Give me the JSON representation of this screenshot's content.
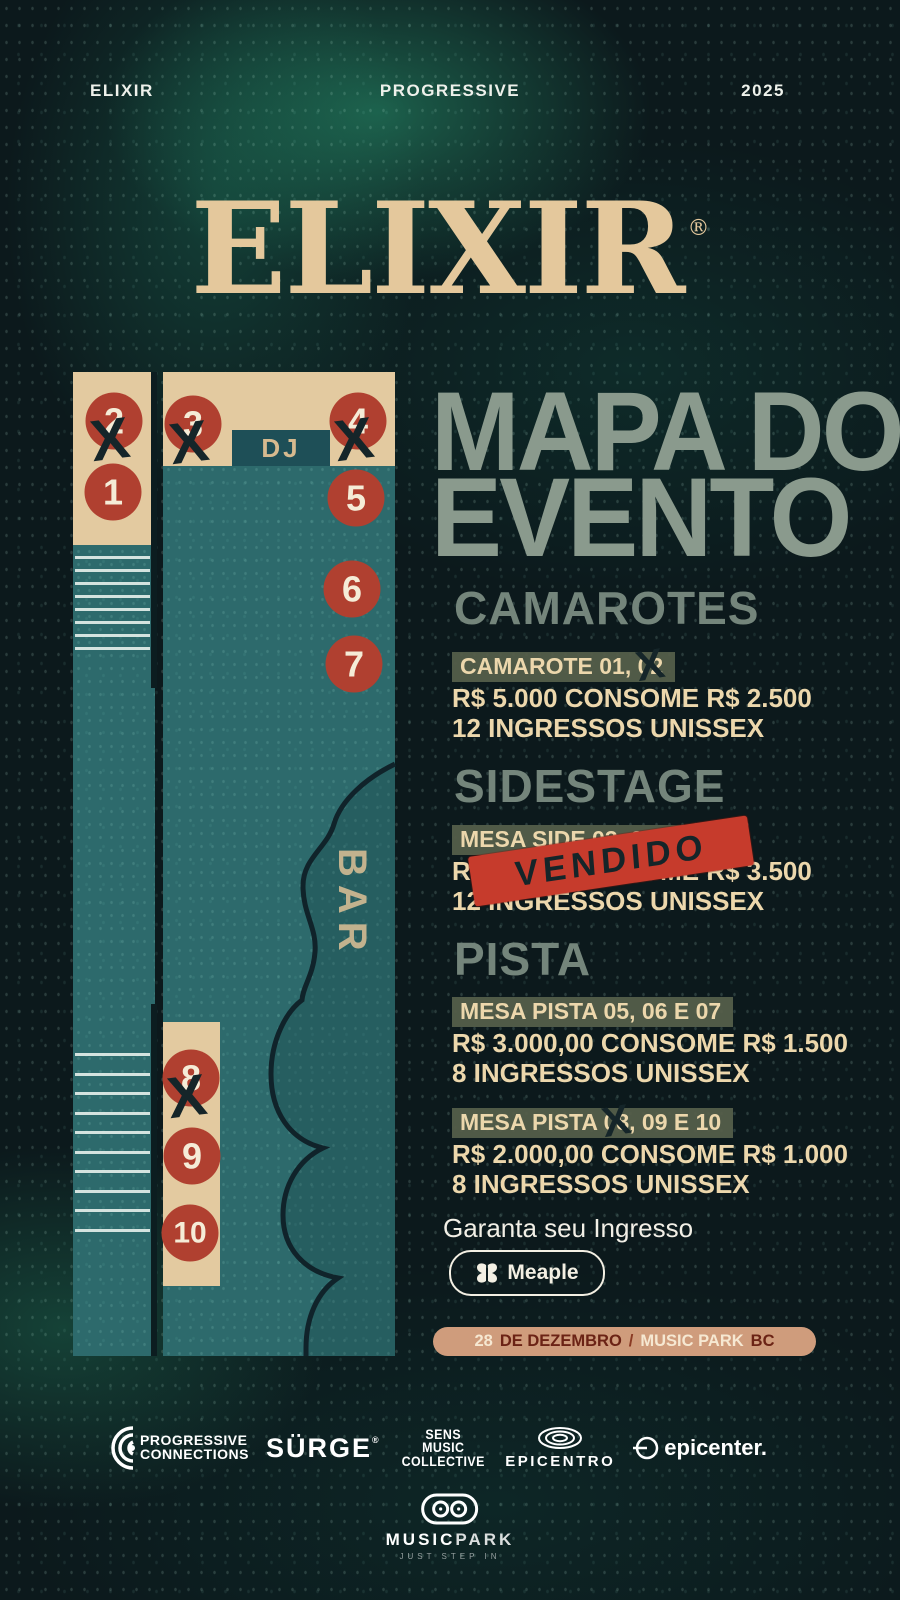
{
  "header": {
    "left": "ELIXIR",
    "center": "PROGRESSIVE",
    "right": "2025"
  },
  "logo": {
    "text": "ELIXIR",
    "mark": "®"
  },
  "title": {
    "line1": "MAPA DO",
    "line2": "EVENTO"
  },
  "map": {
    "dj": "DJ",
    "bar": "BAR",
    "x": "X",
    "tables": [
      {
        "n": "1",
        "sold": false
      },
      {
        "n": "2",
        "sold": true
      },
      {
        "n": "3",
        "sold": true
      },
      {
        "n": "4",
        "sold": true
      },
      {
        "n": "5",
        "sold": false
      },
      {
        "n": "6",
        "sold": false
      },
      {
        "n": "7",
        "sold": false
      },
      {
        "n": "8",
        "sold": true
      },
      {
        "n": "9",
        "sold": false
      },
      {
        "n": "10",
        "sold": false
      }
    ]
  },
  "sections": {
    "camarotes": {
      "heading": "CAMAROTES",
      "title_pre": "CAMAROTE 01, ",
      "sold": "02",
      "price": "R$ 5.000 CONSOME R$ 2.500",
      "tickets": "12 INGRESSOS UNISSEX"
    },
    "sidestage": {
      "heading": "SIDESTAGE",
      "title": "MESA SIDE 03, 04",
      "price": "R$ 5.000 CONSOME R$ 3.500",
      "tickets": "12 INGRESSOS UNISSEX",
      "stamp": "VENDIDO"
    },
    "pista": {
      "heading": "PISTA",
      "block1": {
        "title": "MESA PISTA 05, 06 E 07",
        "price": "R$ 3.000,00 CONSOME R$ 1.500",
        "tickets": "8 INGRESSOS UNISSEX"
      },
      "block2": {
        "title_pre": "MESA PISTA ",
        "sold": "08",
        "title_post": ", 09 E 10",
        "price": "R$ 2.000,00 CONSOME R$ 1.000",
        "tickets": "8 INGRESSOS UNISSEX"
      }
    }
  },
  "cta": {
    "label": "Garanta seu Ingresso",
    "button": "Meaple"
  },
  "banner": {
    "day": "28",
    "month": "DE DEZEMBRO",
    "sep": "/",
    "venue": "MUSIC PARK",
    "city": "BC"
  },
  "footer": {
    "progressive": {
      "line1": "PROGRESSIVE",
      "line2": "CONNECTIONS"
    },
    "surge": {
      "label": "SÜRGE",
      "mark": "®"
    },
    "sens": {
      "line1": "SENS",
      "line2": "MUSIC",
      "line3": "COLLECTIVE"
    },
    "epicentro": "EPICENTRO",
    "epicenter": "epicenter."
  },
  "musicpark": {
    "name1": "MUSIC",
    "name2": "PARK",
    "tagline": "JUST STEP IN"
  },
  "colors": {
    "cream": "#ecd7ac",
    "tan": "#e3caa0",
    "sage": "#8a9a8d",
    "section_heading": "#74857b",
    "highlight": "#57604b",
    "table_red": "#b04030",
    "stamp_red": "#c63b2c",
    "ink": "#152529",
    "floor_teal": "#2d6a6c",
    "dj_teal": "#1e4f57",
    "banner_bg": "#cf9c7c",
    "banner_dark": "#6b2315"
  }
}
